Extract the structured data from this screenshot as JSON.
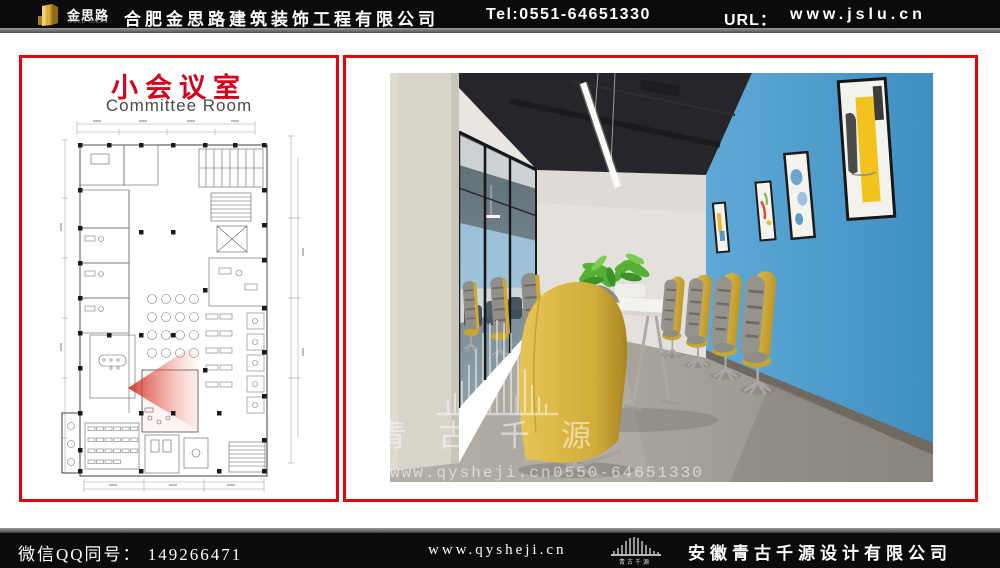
{
  "header": {
    "brand": {
      "name_cn": "金思路",
      "name_en": "GOLD IDEAS"
    },
    "company": "合肥金思路建筑装饰工程有限公司",
    "tel": "Tel:0551-64651330",
    "url_label": "URL：",
    "url": "www.jslu.cn"
  },
  "plan_panel": {
    "title_cn": "小会议室",
    "title_en": "Committee Room"
  },
  "photo_panel": {
    "watermark": {
      "brand": "青 古 千 源",
      "site": "www.qysheji.cn",
      "phone": "0550-64651330"
    }
  },
  "footer": {
    "wechat_qq": "微信QQ同号： 149266471",
    "site": "www.qysheji.cn",
    "brand_caption": "青古千源",
    "company": "安徽青古千源设计有限公司"
  },
  "colors": {
    "accent_red": "#e8000f",
    "wall_blue": "#4f9fd0",
    "chair_yellow": "#d5b13d",
    "brand_gold": "#d4a72c",
    "bar_black": "#0b0b0b"
  }
}
